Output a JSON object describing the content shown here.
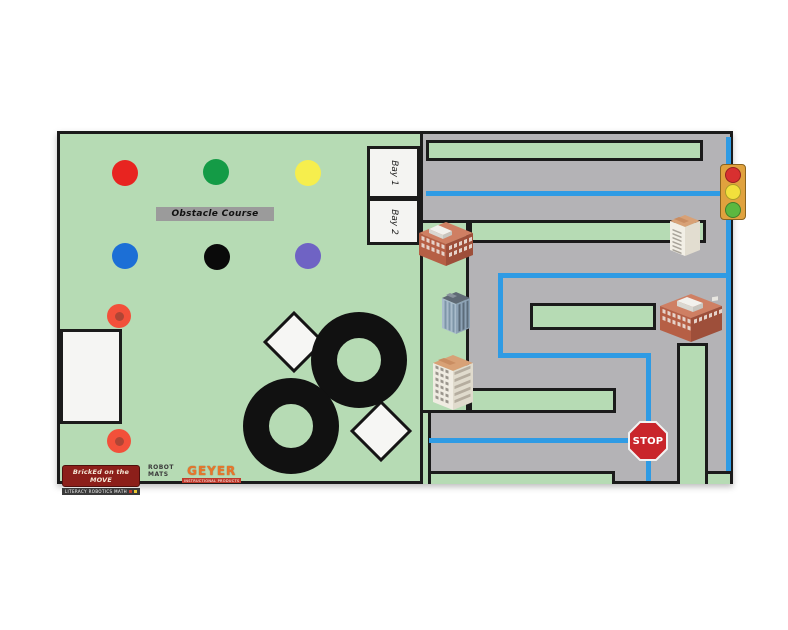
{
  "mat_title": "Robotics practice mat: obstacle course and city line-follow map",
  "colors": {
    "mat_green": "#b6dbb4",
    "road_gray": "#b4b3b6",
    "line_blue": "#2f9be4",
    "line_black": "#1b1b1b"
  },
  "obstacle_course": {
    "label": "Obstacle Course",
    "bays": [
      {
        "label": "Bay 1"
      },
      {
        "label": "Bay 2"
      }
    ],
    "dot_markers": [
      {
        "name": "red",
        "color": "#e82420"
      },
      {
        "name": "green",
        "color": "#149b46"
      },
      {
        "name": "yellow",
        "color": "#f6ee4d"
      },
      {
        "name": "blue",
        "color": "#1c6fd6"
      },
      {
        "name": "black",
        "color": "#0a0a0a"
      },
      {
        "name": "purple",
        "color": "#6f63c4"
      }
    ],
    "spot_marker_color": "#f2503a",
    "track_color": "#111111"
  },
  "city": {
    "stop_sign": {
      "label": "STOP",
      "color": "#c9252b"
    },
    "traffic_light": {
      "body_color": "#e0a23e",
      "lights": [
        "#d83030",
        "#f2e03c",
        "#5cb840"
      ]
    }
  },
  "branding": {
    "primary_logo": "BrickEd on the MOVE",
    "primary_tagline": "LITERACY ROBOTICS MATH",
    "robot_mats_line1": "ROBOT",
    "robot_mats_line2": "MATS",
    "geyer": "GEYER",
    "geyer_tagline": "INSTRUCTIONAL PRODUCTS"
  }
}
